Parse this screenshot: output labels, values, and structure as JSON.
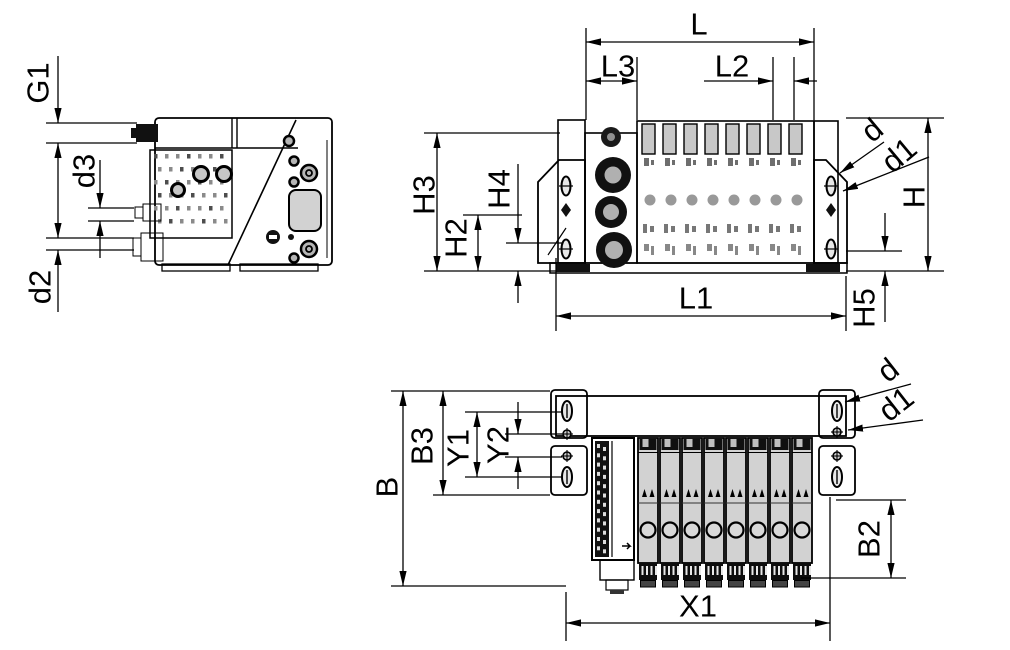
{
  "drawing_type": "valve-terminal-dimensional-drawing",
  "colors": {
    "background": "#ffffff",
    "line": "#000000",
    "body_gray": "#d2d2d2",
    "dark_fill": "#111111"
  },
  "views": {
    "side": {
      "name": "side-view",
      "labels": {
        "G1": "G1",
        "d3": "d3",
        "d2": "d2"
      }
    },
    "front": {
      "name": "front-view",
      "valve_slots": 8,
      "labels": {
        "L": "L",
        "L3": "L3",
        "L2": "L2",
        "H3": "H3",
        "H4": "H4",
        "H2": "H2",
        "L1": "L1",
        "H": "H",
        "H5": "H5",
        "d": "d",
        "d1": "d1"
      }
    },
    "top": {
      "name": "top-view",
      "valve_slices": 8,
      "labels": {
        "B": "B",
        "B3": "B3",
        "Y1": "Y1",
        "Y2": "Y2",
        "X1": "X1",
        "B2": "B2",
        "d": "d",
        "d1": "d1"
      }
    }
  }
}
